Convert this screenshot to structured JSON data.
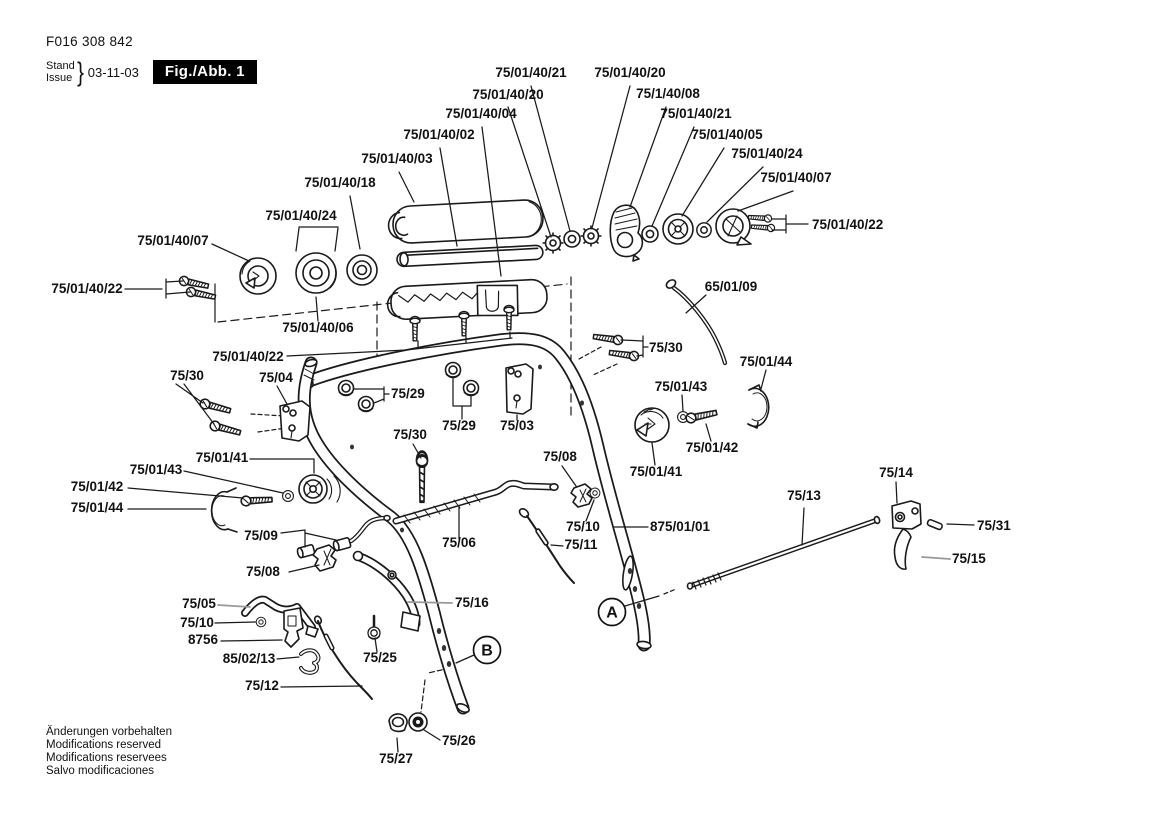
{
  "header": {
    "document_number": "F016 308 842",
    "stand_label": "Stand",
    "issue_label": "Issue",
    "brace": "}",
    "date": "03-11-03",
    "figure_label": "Fig./Abb. 1"
  },
  "footer": {
    "lines": [
      "Änderungen vorbehalten",
      "Modifications reserved",
      "Modifications reservees",
      "Salvo modificaciones"
    ]
  },
  "colors": {
    "line": "#1a1a1a",
    "background": "#ffffff",
    "figure_box_bg": "#000000",
    "figure_box_fg": "#ffffff"
  },
  "view_markers": [
    {
      "id": "A",
      "x": 612,
      "y": 612
    },
    {
      "id": "B",
      "x": 487,
      "y": 650
    }
  ],
  "labels": [
    {
      "text": "75/01/40/21",
      "x": 531,
      "y": 77
    },
    {
      "text": "75/01/40/20",
      "x": 630,
      "y": 77
    },
    {
      "text": "75/01/40/20",
      "x": 508,
      "y": 99
    },
    {
      "text": "75/1/40/08",
      "x": 668,
      "y": 98
    },
    {
      "text": "75/01/40/04",
      "x": 481,
      "y": 118
    },
    {
      "text": "75/01/40/21",
      "x": 696,
      "y": 118
    },
    {
      "text": "75/01/40/02",
      "x": 439,
      "y": 139
    },
    {
      "text": "75/01/40/05",
      "x": 727,
      "y": 139
    },
    {
      "text": "75/01/40/03",
      "x": 397,
      "y": 163
    },
    {
      "text": "75/01/40/24",
      "x": 767,
      "y": 158
    },
    {
      "text": "75/01/40/18",
      "x": 340,
      "y": 187
    },
    {
      "text": "75/01/40/07",
      "x": 796,
      "y": 182
    },
    {
      "text": "75/01/40/24",
      "x": 301,
      "y": 220
    },
    {
      "text": "75/01/40/22",
      "x": 812,
      "y": 229,
      "anchor": "start"
    },
    {
      "text": "75/01/40/07",
      "x": 173,
      "y": 245
    },
    {
      "text": "75/01/40/22",
      "x": 87,
      "y": 293
    },
    {
      "text": "65/01/09",
      "x": 731,
      "y": 291
    },
    {
      "text": "75/01/40/06",
      "x": 318,
      "y": 332
    },
    {
      "text": "75/01/40/22",
      "x": 248,
      "y": 361
    },
    {
      "text": "75/30",
      "x": 187,
      "y": 380
    },
    {
      "text": "75/04",
      "x": 276,
      "y": 382
    },
    {
      "text": "75/29",
      "x": 391,
      "y": 398,
      "anchor": "start"
    },
    {
      "text": "75/30",
      "x": 649,
      "y": 352,
      "anchor": "start"
    },
    {
      "text": "75/01/44",
      "x": 766,
      "y": 366
    },
    {
      "text": "75/01/43",
      "x": 681,
      "y": 391
    },
    {
      "text": "75/29",
      "x": 459,
      "y": 430
    },
    {
      "text": "75/03",
      "x": 517,
      "y": 430
    },
    {
      "text": "75/30",
      "x": 410,
      "y": 439
    },
    {
      "text": "75/01/43",
      "x": 156,
      "y": 474
    },
    {
      "text": "75/01/41",
      "x": 222,
      "y": 462
    },
    {
      "text": "75/01/41",
      "x": 656,
      "y": 476
    },
    {
      "text": "75/01/42",
      "x": 712,
      "y": 452
    },
    {
      "text": "75/01/42",
      "x": 97,
      "y": 491
    },
    {
      "text": "75/08",
      "x": 560,
      "y": 461
    },
    {
      "text": "75/01/44",
      "x": 97,
      "y": 512
    },
    {
      "text": "75/14",
      "x": 896,
      "y": 477
    },
    {
      "text": "75/13",
      "x": 804,
      "y": 500
    },
    {
      "text": "875/01/01",
      "x": 650,
      "y": 531,
      "anchor": "start"
    },
    {
      "text": "75/10",
      "x": 583,
      "y": 531
    },
    {
      "text": "75/11",
      "x": 581,
      "y": 549
    },
    {
      "text": "75/09",
      "x": 261,
      "y": 540
    },
    {
      "text": "75/06",
      "x": 459,
      "y": 547
    },
    {
      "text": "75/31",
      "x": 977,
      "y": 530,
      "anchor": "start"
    },
    {
      "text": "75/15",
      "x": 952,
      "y": 563,
      "anchor": "start"
    },
    {
      "text": "75/08",
      "x": 263,
      "y": 576
    },
    {
      "text": "75/05",
      "x": 199,
      "y": 608
    },
    {
      "text": "75/16",
      "x": 455,
      "y": 607,
      "anchor": "start"
    },
    {
      "text": "75/10",
      "x": 197,
      "y": 627
    },
    {
      "text": "8756",
      "x": 203,
      "y": 644
    },
    {
      "text": "85/02/13",
      "x": 249,
      "y": 663
    },
    {
      "text": "75/25",
      "x": 380,
      "y": 662
    },
    {
      "text": "75/12",
      "x": 262,
      "y": 690
    },
    {
      "text": "75/26",
      "x": 442,
      "y": 745,
      "anchor": "start"
    },
    {
      "text": "75/27",
      "x": 396,
      "y": 763
    }
  ]
}
